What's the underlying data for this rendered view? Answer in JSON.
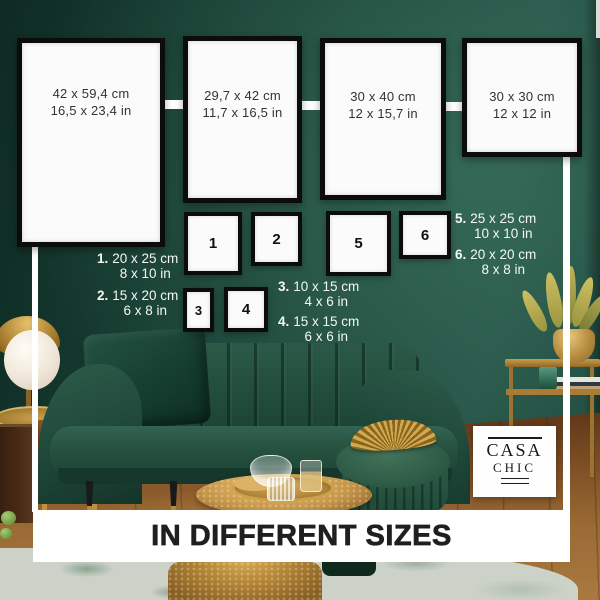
{
  "brand": {
    "line1": "CASA",
    "line2": "CHIC"
  },
  "banner": {
    "title": "IN DIFFERENT SIZES"
  },
  "size_chart": {
    "large_frames": [
      {
        "cm": "42 x 59,4 cm",
        "inch": "16,5 x 23,4 in"
      },
      {
        "cm": "29,7 x 42 cm",
        "inch": "11,7 x 16,5 in"
      },
      {
        "cm": "30 x 40 cm",
        "inch": "12 x 15,7 in"
      },
      {
        "cm": "30 x 30 cm",
        "inch": "12 x 12 in"
      }
    ],
    "numbered_frames": [
      {
        "num": "1"
      },
      {
        "num": "2"
      },
      {
        "num": "3"
      },
      {
        "num": "4"
      },
      {
        "num": "5"
      },
      {
        "num": "6"
      }
    ],
    "legend": [
      {
        "num": "1.",
        "cm": "20 x 25 cm",
        "inch": "8 x 10 in"
      },
      {
        "num": "2.",
        "cm": "15 x 20 cm",
        "inch": "6 x 8 in"
      },
      {
        "num": "3.",
        "cm": "10 x 15 cm",
        "inch": "4 x 6 in"
      },
      {
        "num": "4.",
        "cm": "15 x 15 cm",
        "inch": "6 x 6 in"
      },
      {
        "num": "5.",
        "cm": "25 x 25 cm",
        "inch": "10 x 10 in"
      },
      {
        "num": "6.",
        "cm": "20 x 20 cm",
        "inch": "8 x 8 in"
      }
    ]
  },
  "colors": {
    "wall_green": "#1d4a3d",
    "accent_gold": "#c09a4a",
    "frame_border": "#0c0c0c",
    "banner_bg": "#ffffff",
    "banner_text": "#1f1f1f",
    "legend_text": "#f4f7f4"
  }
}
